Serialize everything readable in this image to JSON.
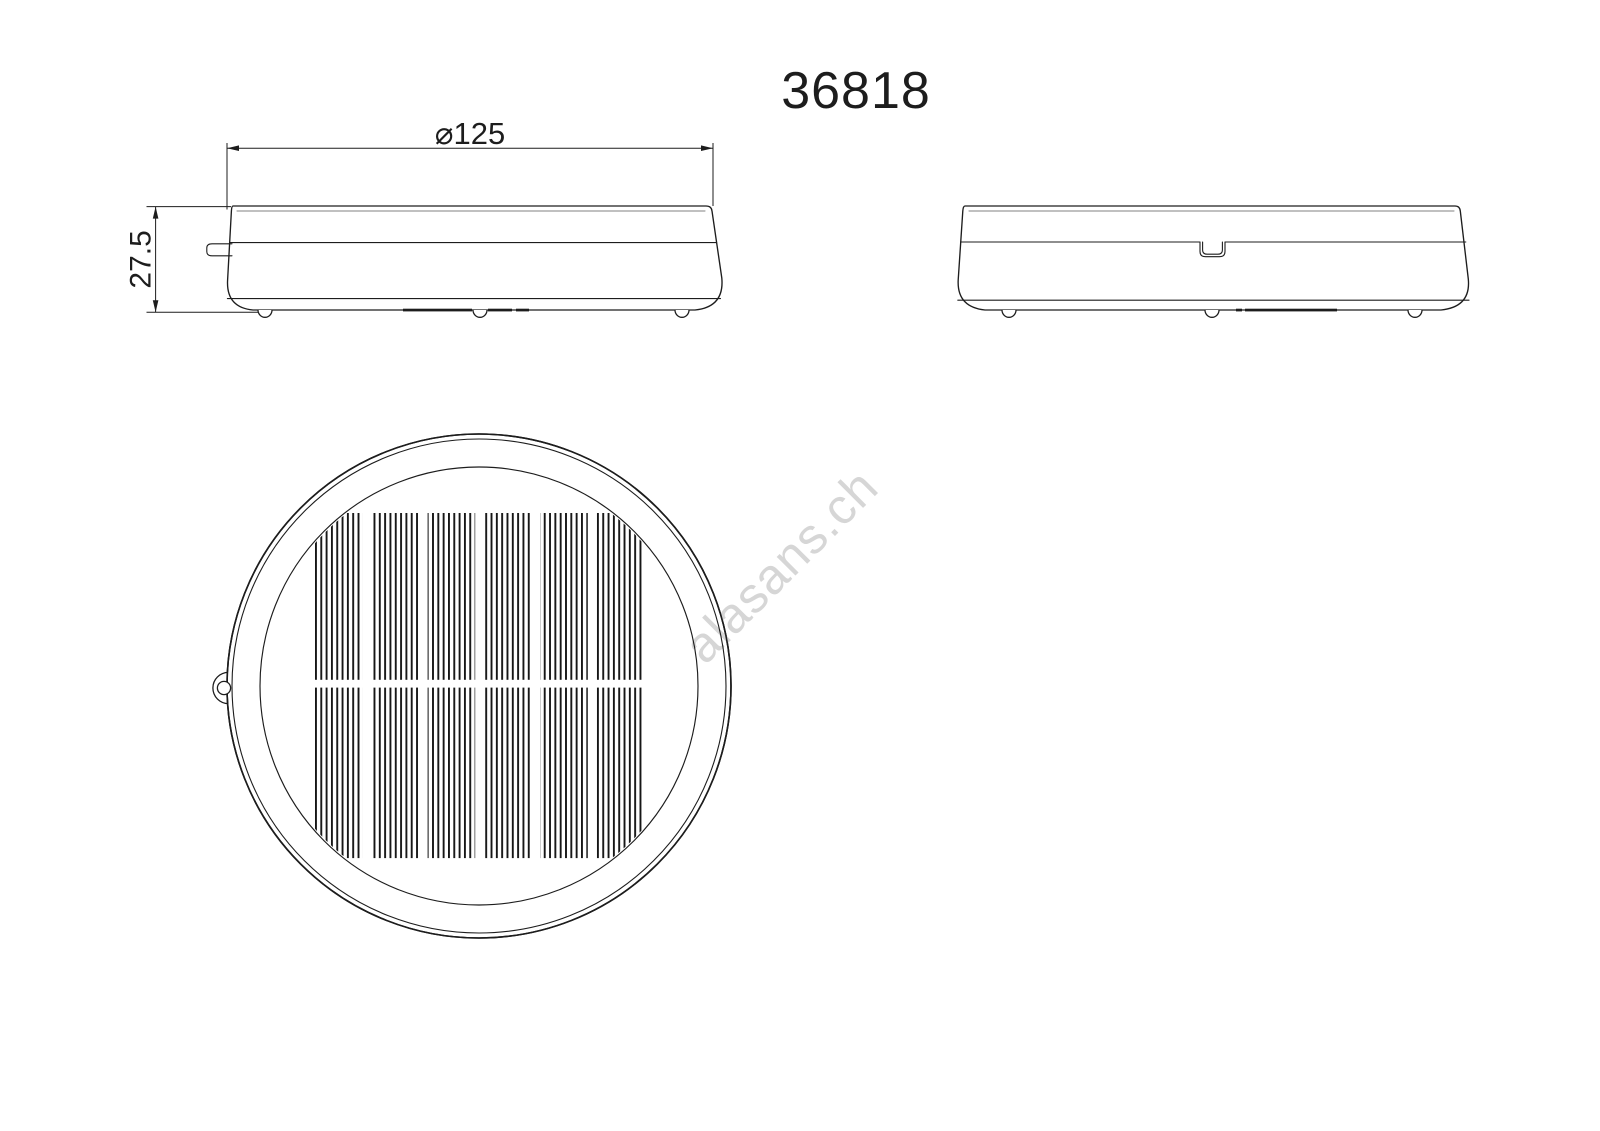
{
  "title": "36818",
  "watermark": "alasans.ch",
  "dimensions": {
    "diameter_label": "⌀125",
    "height_label": "27.5"
  },
  "colors": {
    "background": "#ffffff",
    "line": "#1d1d1d",
    "rim_line": "#9b9b9b",
    "stripe": "#161616",
    "watermark": "#d6d6d6"
  }
}
